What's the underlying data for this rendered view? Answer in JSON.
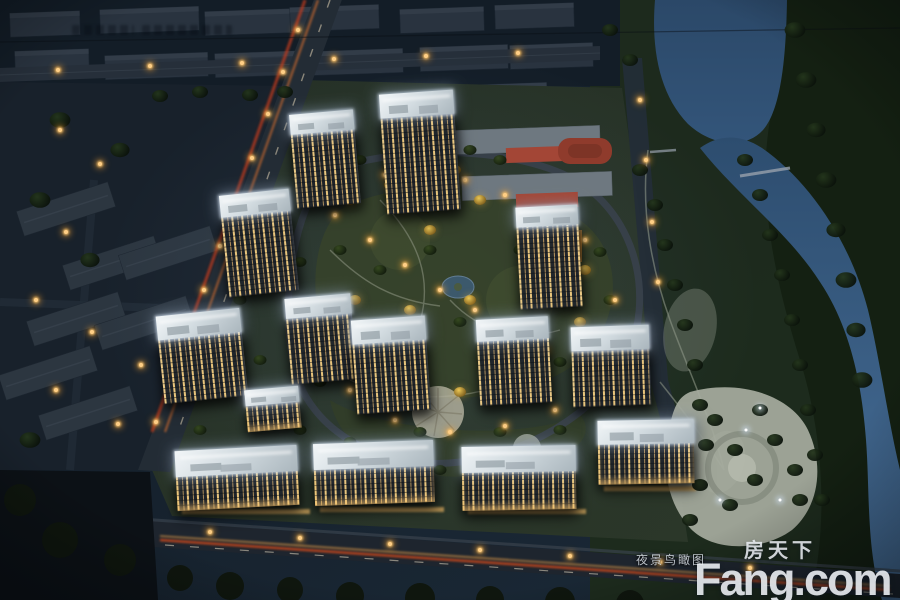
{
  "overlay": {
    "caption_label": "夜景鸟瞰图",
    "watermark_cn": "房天下",
    "watermark_en": "Fang.com"
  },
  "palette": {
    "night_sky": "#16212d",
    "city_block": "#29333f",
    "water": "#2e4f72",
    "water_bright": "#48709a",
    "foliage_dark": "#1a2818",
    "foliage_autumn": "#cda544",
    "lawn": "#3a4730",
    "roof_white": "#e7edf0",
    "window_warm": "#f0cf8a",
    "road": "#232c36",
    "traffic_streak_red": "#d24a1e",
    "traffic_streak_amber": "#f0a44c",
    "street_lamp": "#f6ab42",
    "plaza_gray": "#a7ad9f",
    "school_red": "#9c4434",
    "watermark_white": "#eef2f5"
  }
}
